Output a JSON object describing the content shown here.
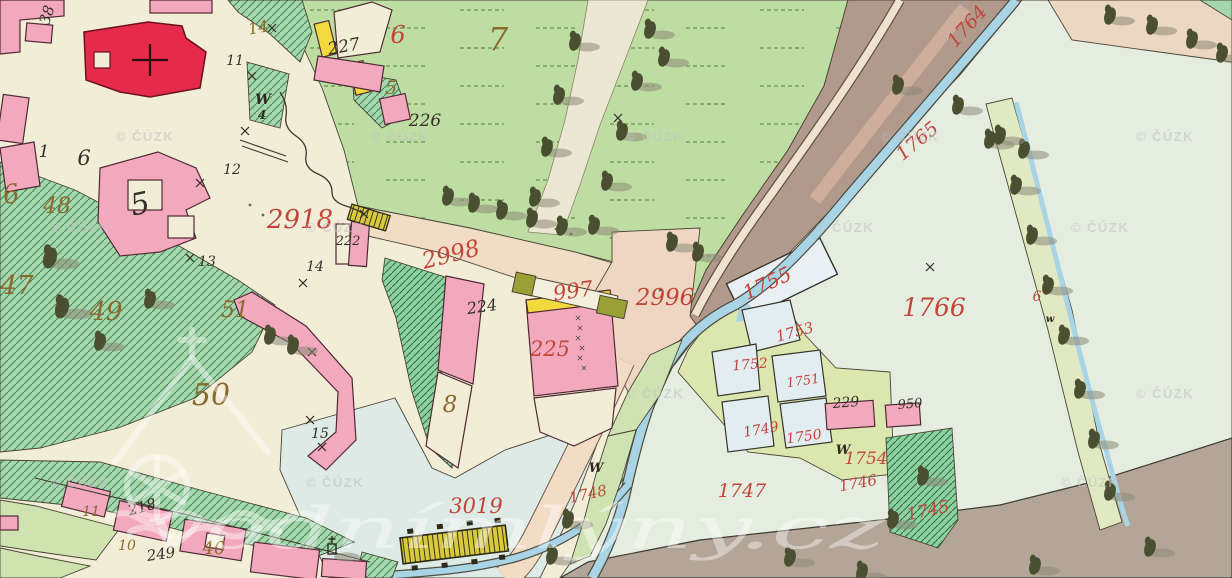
{
  "map": {
    "type": "historical cadastral map scan",
    "watermarks": {
      "copyright": "© ČÚZK",
      "site": "vodnímlýny.cz"
    },
    "palette": {
      "paper": "#f2edd7",
      "meadow": "#bedda2",
      "field_pale": "#e5ede1",
      "garden_green": "#a5d7ac",
      "water": "#a8d4e6",
      "road_brown": "#b19a8c",
      "road_gray": "#b3a698",
      "road_salmon": "#f1ddc6",
      "pond_cluster": "#dbe7ae",
      "building_pink": "#f2a9bd",
      "building_red": "#e62a4b",
      "building_yellow": "#f2d93e",
      "bridge_yellow": "#d8ca3e",
      "label_red": "#c2453a",
      "label_black": "#35302a",
      "label_brown": "#8a6a2e"
    },
    "labels": {
      "red": {
        "p6a": "6",
        "p2918": "2918",
        "p2998": "2998",
        "p997": "997",
        "p2996": "2996",
        "p225": "225",
        "p3019": "3019",
        "p1748": "1748",
        "p1747": "1747",
        "p1745": "1745",
        "p1746": "1746",
        "p1754": "1754",
        "p1750": "1750",
        "p1749": "1749",
        "p1752": "1752",
        "p1751": "1751",
        "p1753": "1753",
        "p1755": "1755",
        "p1766": "1766",
        "p1764": "1764",
        "p1765": "1765",
        "p6b": "6"
      },
      "black": {
        "p38": "38",
        "p11": "11",
        "p227": "227",
        "p226": "226",
        "p222": "222",
        "p224": "224",
        "p218": "218",
        "p249": "249",
        "p229": "229",
        "p950": "950",
        "h1": "1",
        "h5": "5",
        "h6": "6",
        "h12": "12",
        "h13": "13",
        "h14": "14",
        "h15": "15"
      },
      "brown": {
        "t5": "5",
        "t6": "6",
        "t7": "7",
        "t8": "8",
        "t10": "10",
        "t11": "11",
        "t14": "14",
        "t40": "40",
        "t47": "47",
        "t48": "48",
        "t49": "49",
        "t50": "50",
        "t51": "51"
      },
      "symbols": {
        "w_upper": "W",
        "w_lower": "w",
        "class4": "4"
      }
    }
  }
}
